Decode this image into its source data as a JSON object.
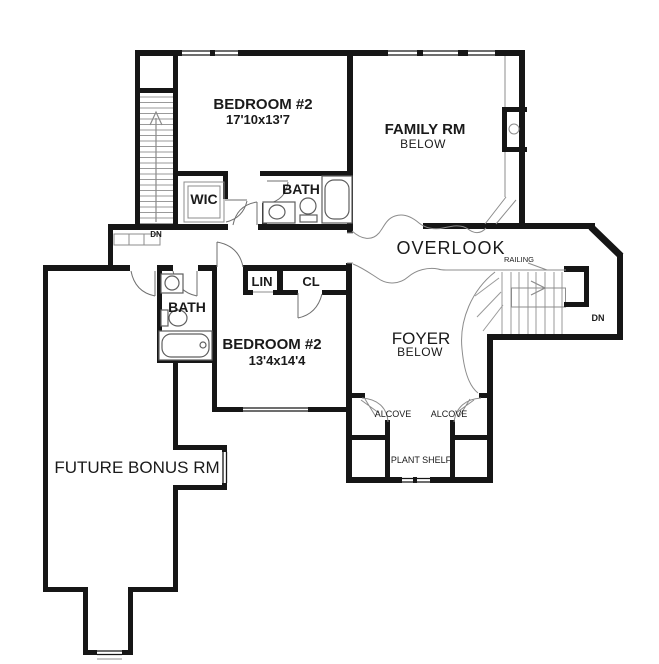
{
  "plan": {
    "colors": {
      "wall": "#161616",
      "thin_line": "#8c8c8c",
      "text": "#1a1a1a",
      "background": "#ffffff"
    },
    "rooms": {
      "bedroom_upper": {
        "name": "BEDROOM #2",
        "dims": "17'10x13'7"
      },
      "family_room": {
        "name": "FAMILY RM",
        "level": "BELOW"
      },
      "wic": {
        "name": "WIC"
      },
      "bath_upper": {
        "name": "BATH"
      },
      "bath_lower": {
        "name": "BATH"
      },
      "linen": {
        "name": "LIN"
      },
      "closet": {
        "name": "CL"
      },
      "bedroom_lower": {
        "name": "BEDROOM #2",
        "dims": "13'4x14'4"
      },
      "overlook": {
        "name": "OVERLOOK"
      },
      "foyer": {
        "name": "FOYER",
        "level": "BELOW"
      },
      "future_bonus": {
        "name": "FUTURE BONUS RM"
      },
      "alcove_left": {
        "name": "ALCOVE"
      },
      "alcove_right": {
        "name": "ALCOVE"
      },
      "plant_shelf": {
        "name": "PLANT SHELF"
      }
    },
    "labels": {
      "railing": "RAILING",
      "dn_upper_stairs": "DN",
      "dn_lower_stairs": "DN"
    }
  }
}
